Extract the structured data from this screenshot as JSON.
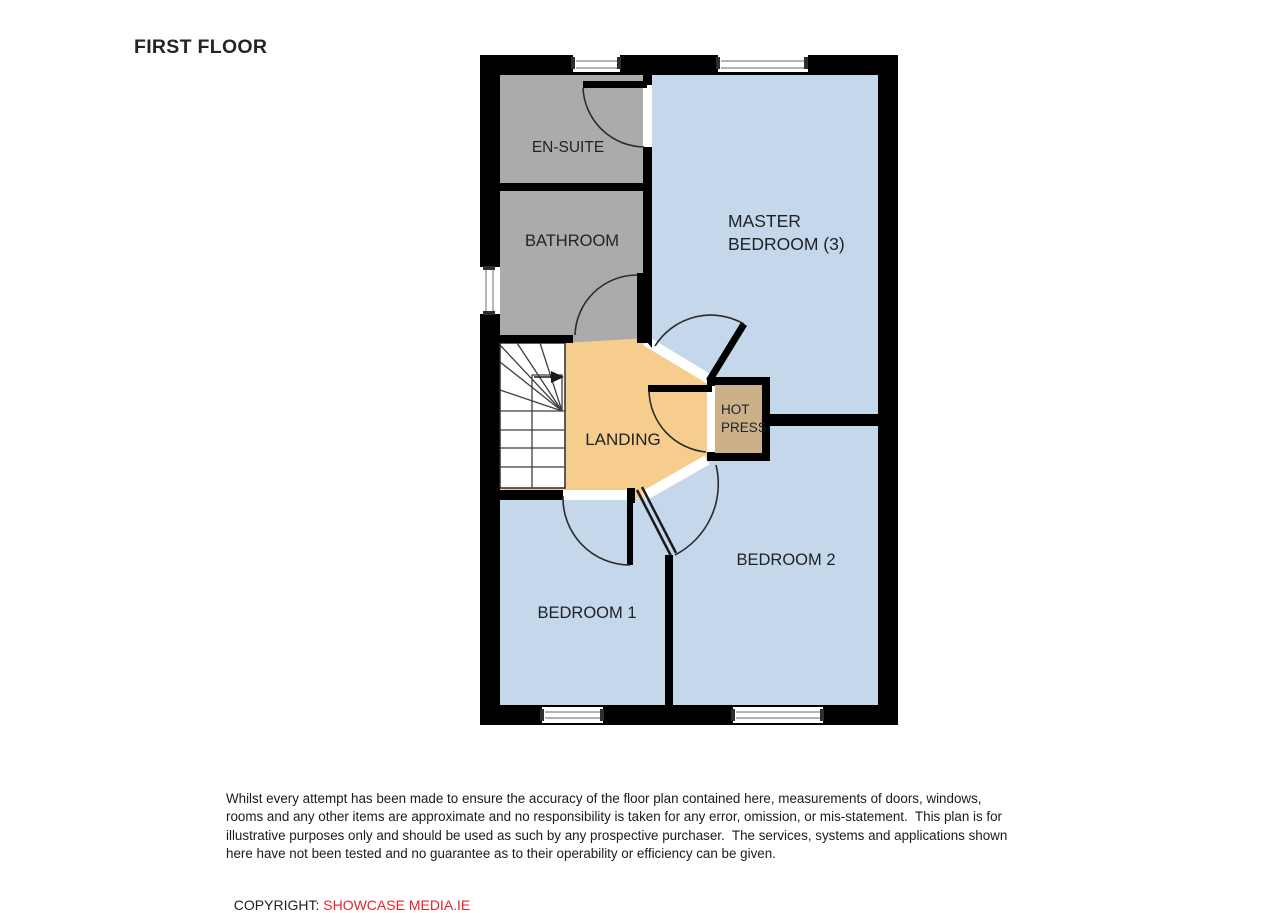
{
  "title": "FIRST FLOOR",
  "colors": {
    "wall": "#000000",
    "bedroom_fill": "#c5d8eb",
    "bathroom_fill": "#ababab",
    "landing_fill": "#f7cd8e",
    "hot_press_fill": "#ccb188",
    "stairs_fill": "#ffffff",
    "copyright_red": "#e8232b"
  },
  "rooms": {
    "en_suite": "EN-SUITE",
    "bathroom": "BATHROOM",
    "master_bedroom_line1": "MASTER",
    "master_bedroom_line2": "BEDROOM (3)",
    "landing": "LANDING",
    "hot_press_line1": "HOT",
    "hot_press_line2": "PRESS",
    "bedroom1": "BEDROOM 1",
    "bedroom2": "BEDROOM 2"
  },
  "disclaimer": {
    "lines": [
      "Whilst every attempt has been made to ensure the accuracy of the floor plan contained here, measurements of doors, windows,",
      "rooms and any other items are approximate and no responsibility is taken for any error, omission, or mis-statement.  This plan is for",
      "illustrative purposes only and should be used as such by any prospective purchaser.  The services, systems and applications shown",
      "here have not been tested and no guarantee as to their operability or efficiency can be given."
    ]
  },
  "copyright": {
    "label": "COPYRIGHT: ",
    "company": "SHOWCASE MEDIA.IE"
  }
}
